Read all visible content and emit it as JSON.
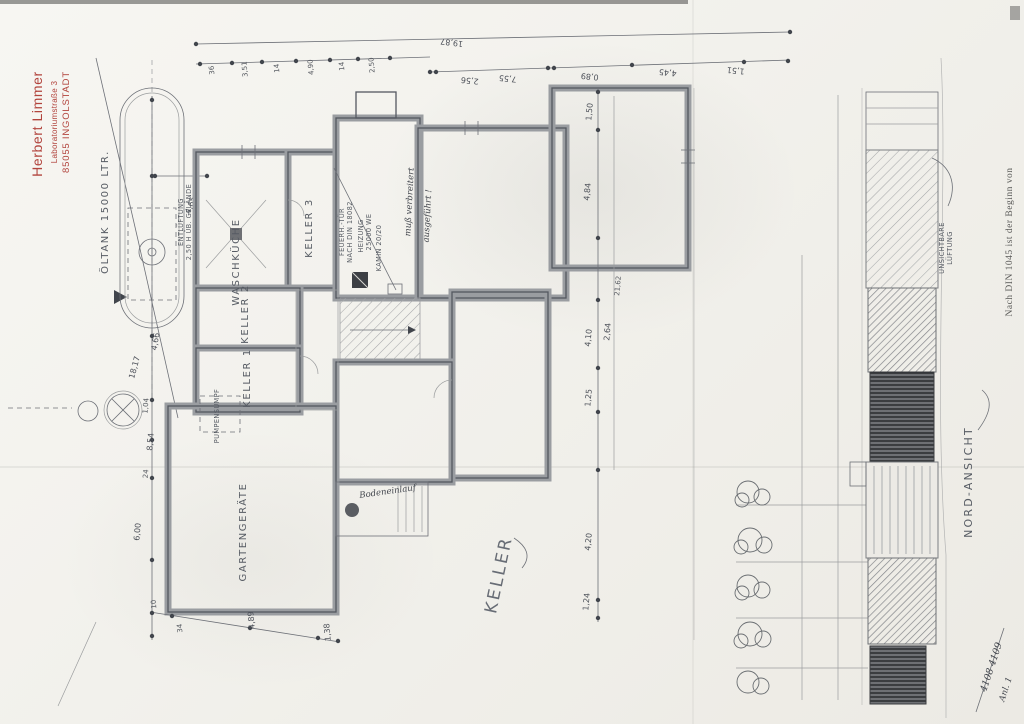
{
  "page": {
    "title": "KELLER"
  },
  "stamp": {
    "line1": "Herbert Limmer",
    "line2": "Laboratoriumstraße 3",
    "line3": "85055 INGOLSTADT"
  },
  "rooms": {
    "oeltank": "ÖLTANK 15000 LTR.",
    "waschkueche": "WASCHKÜCHE",
    "keller3": "KELLER 3",
    "keller2": "KELLER 2",
    "keller1": "KELLER 1",
    "gartengeraete": "GARTENGERÄTE",
    "pumpensumpf": "PUMPENSUMPF",
    "keller_title": "KELLER"
  },
  "notes": {
    "entlueftung_l1": "ENTLÜFTUNG",
    "entlueftung_l2": "2,50 H ÜB. GELÄNDE",
    "feuertuer_l1": "FEUERH.-TÜR",
    "feuertuer_l2": "NACH DIN 18082",
    "heizung_l1": "HEIZUNG",
    "heizung_l2": "25000 WE",
    "kamin": "KAMIN 20/20",
    "hand_l1": "muß verbreitert",
    "hand_l2": "ausgeführt !",
    "bodeneinlauf": "Bodeneinlauf"
  },
  "dims": {
    "total_top": "19,87",
    "top": [
      "36",
      "3,51",
      "14",
      "4,90",
      "14",
      "2,50"
    ],
    "top_right": [
      "2,56",
      "7,55",
      "0,89",
      "4,45",
      "1,51"
    ],
    "left": [
      "4,65",
      "4,66",
      "18,17",
      "1,04",
      "8,54",
      "24",
      "6,00"
    ],
    "right": [
      "1,50",
      "4,84",
      "4,10",
      "1,25",
      "4,20",
      "1,24",
      "2,64",
      "21,62"
    ],
    "bottom": [
      "10",
      "34",
      "4,89",
      "1,38"
    ]
  },
  "elevation": {
    "title": "NORD-ANSICHT",
    "vent_l1": "UNSICHTBARE",
    "vent_l2": "LÜFTUNG"
  },
  "margin_note": "Nach DIN 1045 ist der Beginn von",
  "corner": {
    "l1": "4108 4109",
    "l2": "Anl. 1"
  }
}
